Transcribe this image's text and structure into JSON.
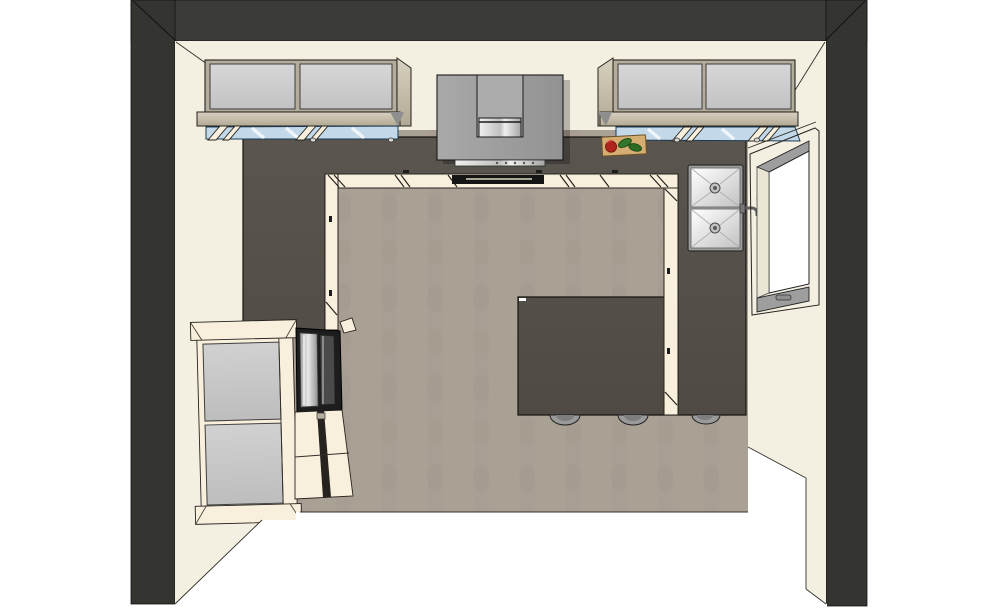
{
  "scene": {
    "type": "3d-top-view-render",
    "room": "kitchen"
  },
  "palette": {
    "wall-top": "#3b3b39",
    "wall-side": "#343431",
    "wall-cream": "#f3f0e1",
    "floor": "#aaa195",
    "floor-streak": "#8f8678",
    "counter": "#56524b",
    "counter-edge": "#17150f",
    "cabinet-front": "#f8efdc",
    "trim-tan": "#cbc2ae",
    "glass-gray": "#cbcbcd",
    "glass-blue": "#c3d9e9",
    "hood-gray": "#9c9c9c",
    "hood-chimney": "#acacac",
    "oven-dark": "#1d1d1d",
    "sill-gray": "#9e9e9e",
    "window-glass": "#ffffff",
    "board-tan": "#d5ad72",
    "pepper-red": "#b0261c",
    "pepper-green": "#33782b",
    "stool-gray": "#9a9a9a",
    "fridge-panel": "#c9c9c9",
    "outline": "#26231f"
  },
  "objects": {
    "walls": "room walls",
    "floor": "kitchen floor",
    "countertop": "dark countertop run",
    "base_cabinets": "cream base cabinet fronts",
    "upper_cabinet_left": "glass-door wall cabinet left",
    "upper_cabinet_right": "glass-door wall cabinet right",
    "range_hood": "range hood with chimney",
    "cooktop": "cooktop",
    "oven": "built-in oven front",
    "sink": "double-bowl sink",
    "faucet": "faucet",
    "window": "window",
    "refrigerator": "refrigerator cabinet",
    "wall_ovens": "built-in oven tower",
    "peninsula": "peninsula counter",
    "stools": "bar stools",
    "cutting_board": "cutting board with peppers"
  }
}
